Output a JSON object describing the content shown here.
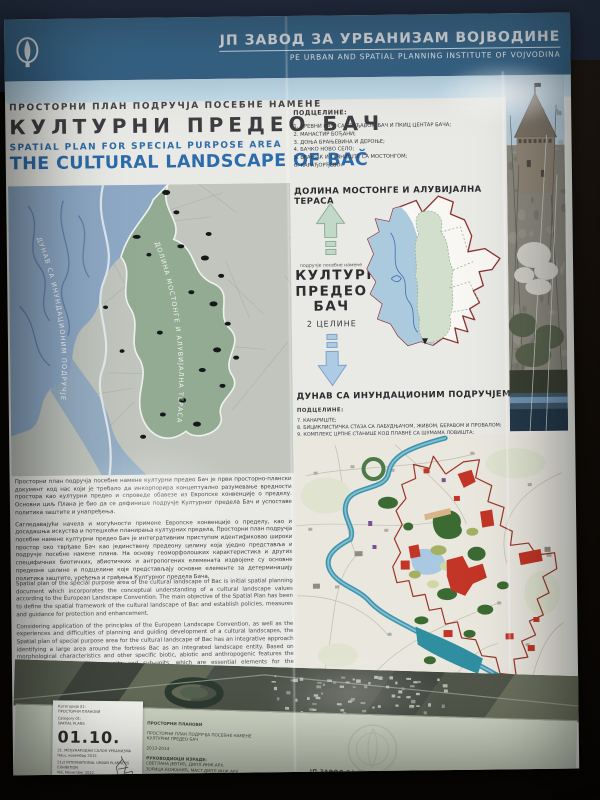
{
  "header": {
    "org_sr": "ЈП ЗАВОД ЗА УРБАНИЗАМ ВОЈВОДИНЕ",
    "org_en": "PE URBAN AND SPATIAL PLANNING INSTITUTE OF VOJVODINA"
  },
  "title_block": {
    "sr_small": "ПРОСТОРНИ ПЛАН ПОДРУЧЈА ПОСЕБНЕ НАМЕНЕ",
    "sr_large": "КУЛТУРНИ ПРЕДЕО БАЧ",
    "en_small": "SPATIAL PLAN FOR SPECIAL PURPOSE AREA",
    "en_large": "THE CULTURAL LANDSCAPE OF BAČ"
  },
  "subunits_top": {
    "heading": "ПОДЦЕЛИНЕ:",
    "items": [
      "1. ДРЕВНИ БАЧ, СА ТВРЂАВОМ БАЧ И ПКИЦ ЦЕНТАР БАЧА;",
      "2. МАНАСТИР БОЂАНИ;",
      "3. ДОЊА БРАЊЕВИНА И ДЕРОЊЕ;",
      "4. БАЧКО НОВО СЕЛО;",
      "5. ВРАЊАК И ГУВНИШТЕ СА МОСТОНГОМ;",
      "6. КАРАЂОРЂЕВО."
    ]
  },
  "mostonga": {
    "heading": "ДОЛИНА МОСТОНГЕ И АЛУВИЈАЛНА ТЕРАСА",
    "zone_label_small": "подручје посебне намене",
    "zone_name_1": "КУЛТУРНИ",
    "zone_name_2": "ПРЕДЕО",
    "zone_name_3": "БАЧ",
    "zone_sub": "2 ЦЕЛИНЕ"
  },
  "danube": {
    "heading": "ДУНАВ СА ИНУНДАЦИОНИМ ПОДРУЧЈЕМ",
    "subheading": "ПОДЦЕЛИНЕ:",
    "items": [
      "7. КАНАРИШТЕ;",
      "8. БИЦИКЛИСТИЧКА СТАЗА СА ЛАБУДЊАЧОМ, ЖИВОМ, БЕРАВОМ И ПРОВАЛОМ;",
      "9. КОМПЛЕКС ЦРПНЕ СТАНИЦЕ КОД ПЛАВНЕ СА ШУМАМА ЛОВИШТА;",
      "10. БУКИНСКИ РИТ;",
      "11. ПАРК ШУМА \"БУКИНСКИ ХРАСТИК\"."
    ]
  },
  "left_map": {
    "label_danube": "ДУНАВ СА ИНУНДАЦИОНИМ ПОДРУЧЈЕМ",
    "label_mostonga": "ДОЛИНА МОСТОНГЕ И АЛУВИЈАЛНА ТЕРАСА"
  },
  "body_text": {
    "sr_p1": "Просторни план подручја посебне намене културни предео Бач је први просторно-плански документ код нас који је требало да инкорпорира концептуално разумевање вредности простора као културни предео и спроведе обавезе из Европске конвенције о пределу. Основни циљ Плана је био да се дефинише подручје Културног предела Бач и успоставе политика заштите и унапређења.",
    "sr_p2": "Сагледавајући начела и могућности примене Европске конвенције о пределу, као и досадашња искуства и потешкоће планирања културних предела, Просторни план подручја посебне намене културни предео Бач је интегративним приступом идентификовао широки простор око тврђаве Бач као јединствену предеону целину која уједно представља и подручје посебне намене плана. На основу геоморфолошких карактеристика и других специфичних биотичких, абиотичких и антропогених елемената издвојене су основне предеоне целине и подцелине које представљају основне елементе за детерминацију политика заштите, уређења и грађења Културног предела Бача.",
    "en_p1": "Spatial plan of the special purpose area of the cultural landscape of Bac is initial spatial planning document which incorporates the conceptual understanding of a cultural landscape values according to the European Landscape Convention. The main objective of the Spatial Plan has been to define the spatial framework of the cultural landscape of Bac and establish policies, measures and guidance for protection and enhancement.",
    "en_p2": "Considering application of the principles of the European Landscape Convention, as well as the experiences and difficulties of planning and guiding development of a cultural landscapes, the Spatial plan of special purpose area for the cultural landscape of Bac has an integrative approach identifying a large area around the fortress Bac as an integrated landscape entity. Based on morphological characteristics and other specific biotic, abiotic and anthropogenic features the Plan distinguishes landscape units and sub-units, which are essential elements for the determination of policy implementation of the Cultural landscapes of Bac."
  },
  "footer": {
    "award_card": {
      "line1": "Категорија 01:",
      "line2": "ПРОСТОРНИ ПЛАНОВИ",
      "line3": "Category 01:",
      "line4": "SPATIAL PLANS",
      "number": "01.10.",
      "line5": "21. МЕЂУНАРОДНИ САЛОН УРБАНИЗМА",
      "line6": "Ниш, новембар 2012.",
      "line7": "21st INTERNATIONAL URBAN PLANNERS EXHIBITION",
      "line8": "Niš, November 2012"
    },
    "credits": {
      "header": "ПРОСТОРНИ ПЛАНОВИ",
      "title1": "ПРОСТОРНИ ПЛАН ПОДРУЧЈА ПОСЕБНЕ НАМЕНЕ",
      "title2": "КУЛТУРНИ ПРЕДЕО БАЧ",
      "years": "2013-2014",
      "lead_label": "РУКОВОДИОЦИ ИЗРАДЕ:",
      "lead1": "СВЕТЛАНА ЈЕВТИЋ, ДИПЛ.ИНЖ.АРХ.",
      "lead2": "ЗОРИЦА БОЖАНИЋ, МАСТ.ДИПЛ.ИНЖ.АРХ.",
      "lead3": "МР ВЛАДИМИР ПИХЛЕР, ДИПЛ.ИНЖ.АРХ.",
      "team": "И СТРУЧНИ ТИМ ЗАВОДА"
    },
    "org": "ЈП ЗАВОД ЗА УРБАНИЗАМ ВОЈВОДИНЕ",
    "website": "WWW.ZAVURBVO.RS",
    "director_label": "ДИРЕКТОР",
    "director_name": "ВЛАДИМИР ЗЕЛЕНОВИЋ, ДИПЛ.ИНЖ.МАШ."
  },
  "colors": {
    "header_teal": "#3e7096",
    "accent_blue": "#2c6cab",
    "boundary_red": "#8c3133",
    "map_blue": "#8ea9c6",
    "map_green": "#93aa93",
    "footer_band": "#c8cfbe"
  }
}
